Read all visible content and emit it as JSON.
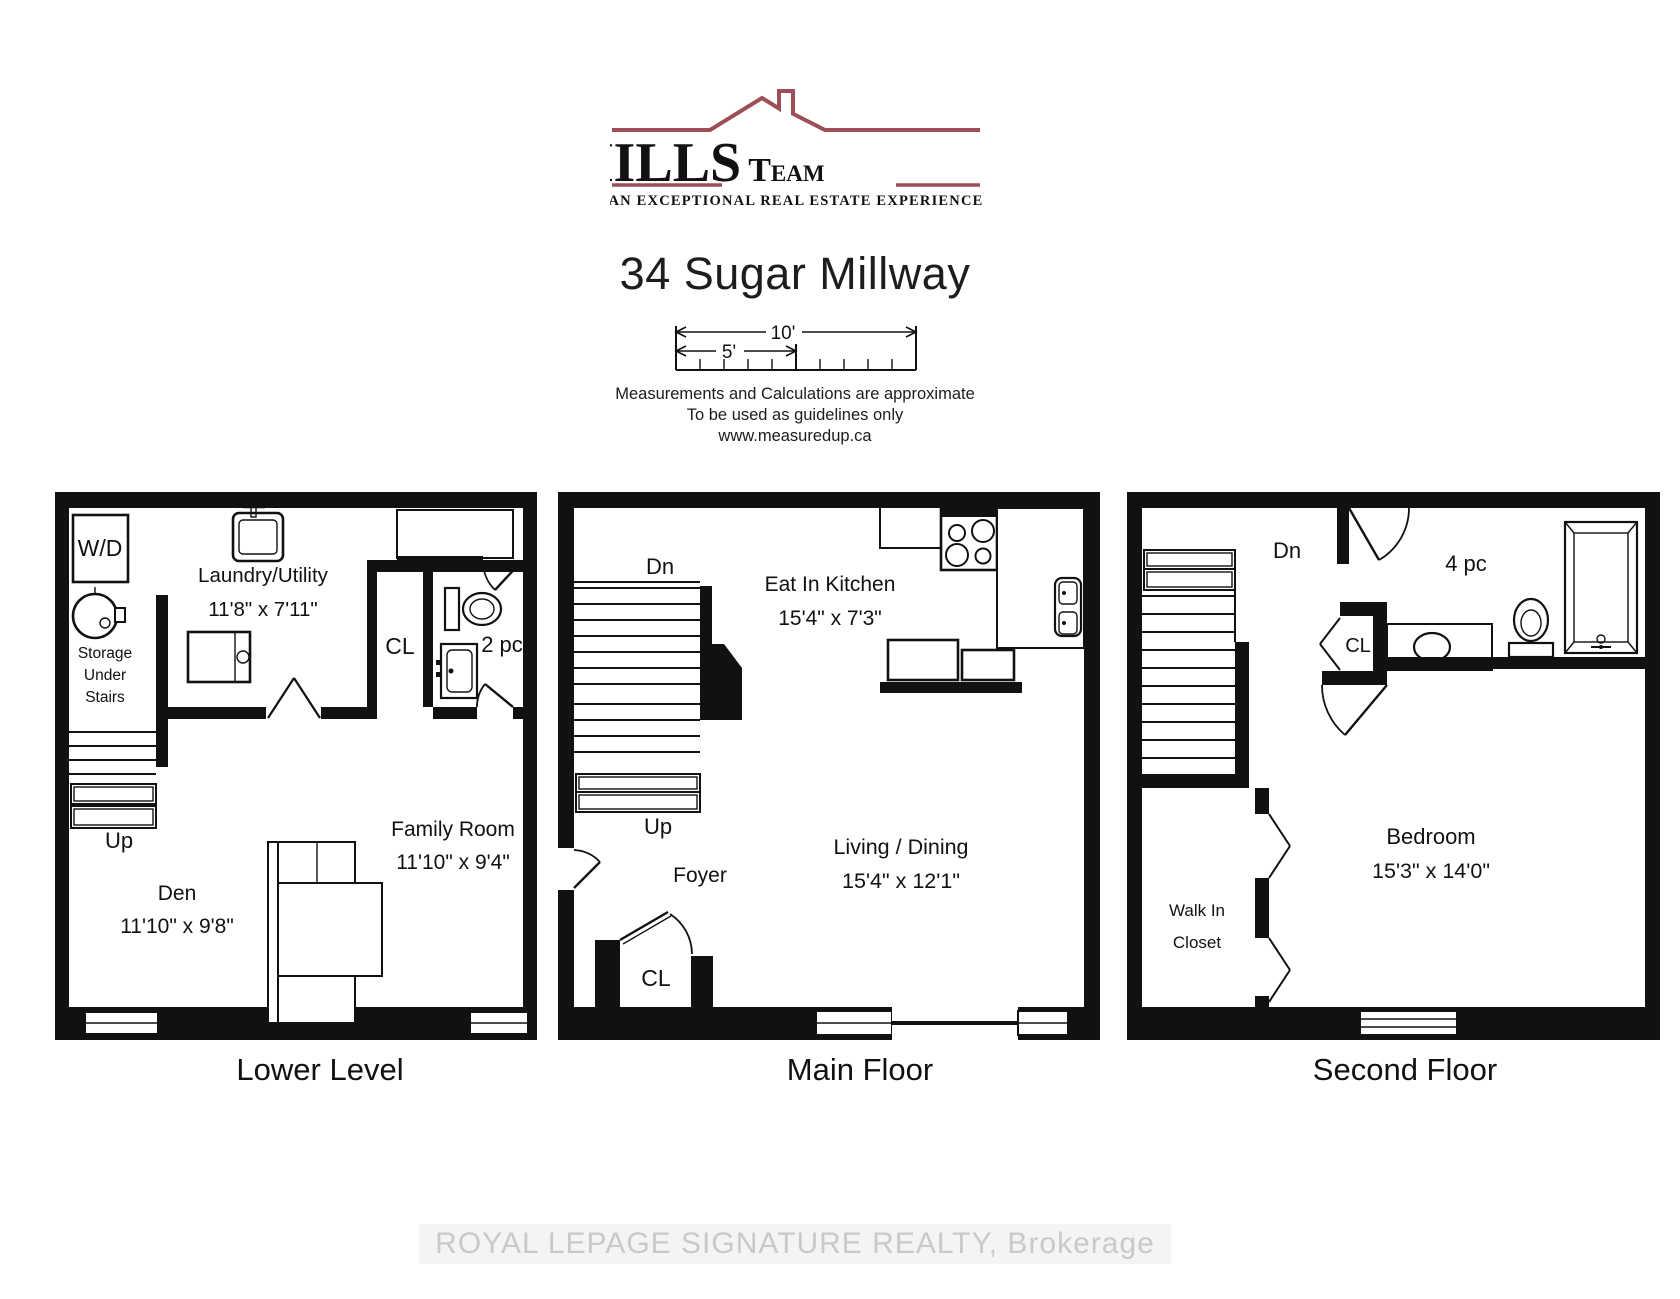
{
  "page": {
    "title": "34 Sugar Millway"
  },
  "logo": {
    "the_initial": "T",
    "the_rest": "HE",
    "mills": "MILLS",
    "team_initial": "T",
    "team_rest": "EAM",
    "tagline": "AN EXCEPTIONAL REAL ESTATE EXPERIENCE",
    "accent_color": "#9e4e56"
  },
  "scale_bar": {
    "full": "10'",
    "half": "5'"
  },
  "disclaimer": {
    "line1": "Measurements and Calculations are approximate",
    "line2": "To be used as guidelines only",
    "line3": "www.measuredup.ca"
  },
  "floors": [
    {
      "name": "Lower Level",
      "labels": {
        "wd": "W/D",
        "storage_line1": "Storage",
        "storage_line2": "Under",
        "storage_line3": "Stairs",
        "laundry": "Laundry/Utility",
        "laundry_dim": "11'8\" x 7'11\"",
        "closet": "CL",
        "bath": "2 pc",
        "stairs": "Up",
        "den": "Den",
        "den_dim": "11'10\" x 9'8\"",
        "family": "Family Room",
        "family_dim": "11'10\" x 9'4\""
      }
    },
    {
      "name": "Main Floor",
      "labels": {
        "stairs_down": "Dn",
        "kitchen": "Eat In Kitchen",
        "kitchen_dim": "15'4\" x 7'3\"",
        "stairs_up": "Up",
        "foyer": "Foyer",
        "closet": "CL",
        "living": "Living / Dining",
        "living_dim": "15'4\" x 12'1\""
      }
    },
    {
      "name": "Second Floor",
      "labels": {
        "stairs_down": "Dn",
        "bath": "4 pc",
        "closet": "CL",
        "wic_line1": "Walk In",
        "wic_line2": "Closet",
        "bedroom": "Bedroom",
        "bedroom_dim": "15'3\" x 14'0\""
      }
    }
  ],
  "watermark": "ROYAL LEPAGE SIGNATURE REALTY, Brokerage"
}
